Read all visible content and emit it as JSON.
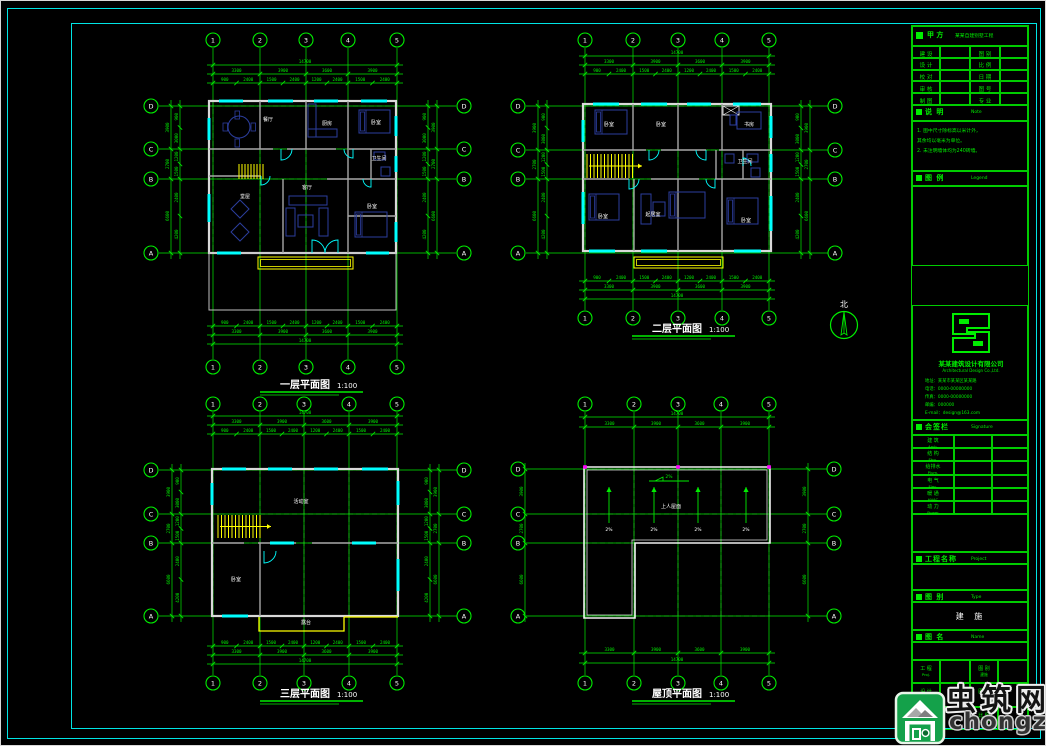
{
  "sheet": {
    "bg": "#000000",
    "frame_color": "#00e5e5",
    "grid_color": "#00ee00",
    "wall_color": "#d9d9d9",
    "inner_wall_color": "#a8a8a8",
    "furniture_color": "#2c3e9e",
    "highlight_color": "#ffff00",
    "window_color": "#00ffff",
    "axis_dot_color": "#ff00ff",
    "label_color": "#ffffff"
  },
  "north_arrow": {
    "label": "北"
  },
  "watermark": {
    "name": "虫筑网",
    "url": "chongzhu.cn"
  },
  "plans": [
    {
      "title": "一层平面图",
      "scale": "1:100",
      "cols": [
        "1",
        "2",
        "3",
        "4",
        "5"
      ],
      "rows": [
        "D",
        "C",
        "B",
        "A"
      ],
      "dims_x": [
        "3300",
        "3900",
        "3600",
        "3900"
      ],
      "total_x": "14700",
      "dims_x_fine": [
        "900",
        "2400",
        "1500",
        "2400",
        "1200",
        "2400",
        "1500",
        "2400"
      ],
      "dims_y": [
        "3900",
        "2700",
        "6600"
      ],
      "total_y": "13200",
      "dims_y_fine": [
        "900",
        "3000",
        "1200",
        "1500",
        "2400",
        "4200"
      ],
      "room_labels": [
        "餐厅",
        "厨房",
        "卧室",
        "客厅",
        "卫生间",
        "卧室",
        "堂屋"
      ]
    },
    {
      "title": "二层平面图",
      "scale": "1:100",
      "cols": [
        "1",
        "2",
        "3",
        "4",
        "5"
      ],
      "rows": [
        "D",
        "C",
        "B",
        "A"
      ],
      "dims_x": [
        "3300",
        "3900",
        "3600",
        "3900"
      ],
      "total_x": "14700",
      "dims_x_fine": [
        "900",
        "2400",
        "1500",
        "2400",
        "1200",
        "2400",
        "1500",
        "2400"
      ],
      "dims_y": [
        "3900",
        "2700",
        "6600"
      ],
      "total_y": "13200",
      "dims_y_fine": [
        "900",
        "3000",
        "1200",
        "1500",
        "2400",
        "4200"
      ],
      "room_labels": [
        "卧室",
        "卧室",
        "书房",
        "起居室",
        "卧室",
        "卧室",
        "卫生间"
      ]
    },
    {
      "title": "三层平面图",
      "scale": "1:100",
      "cols": [
        "1",
        "2",
        "3",
        "4",
        "5"
      ],
      "rows": [
        "D",
        "C",
        "B",
        "A"
      ],
      "dims_x": [
        "3300",
        "3900",
        "3600",
        "3900"
      ],
      "total_x": "14700",
      "dims_x_fine": [
        "900",
        "2400",
        "1500",
        "2400",
        "1200",
        "2400",
        "1500",
        "2400"
      ],
      "dims_y": [
        "3900",
        "2700",
        "6600"
      ],
      "total_y": "13200",
      "dims_y_fine": [
        "900",
        "3000",
        "1200",
        "1500",
        "2400",
        "4200"
      ],
      "room_labels": [
        "活动室",
        "卧室",
        "露台"
      ]
    },
    {
      "title": "屋顶平面图",
      "scale": "1:100",
      "cols": [
        "1",
        "2",
        "3",
        "4",
        "5"
      ],
      "rows": [
        "D",
        "C",
        "B",
        "A"
      ],
      "dims_x": [
        "3300",
        "3900",
        "3600",
        "3900"
      ],
      "total_x": "14700",
      "dims_y": [
        "3900",
        "2700",
        "6600"
      ],
      "total_y": "13200",
      "room_labels": [
        "上人屋面"
      ],
      "slope_labels": [
        "2%",
        "2%",
        "2%",
        "2%"
      ],
      "slope_note": "2%"
    }
  ],
  "title_block": {
    "owner": {
      "label": "甲 方",
      "value": "某某自建别墅工程"
    },
    "info_rows": [
      {
        "l": "建 设",
        "r": "图 别"
      },
      {
        "l": "设 计",
        "r": "比 例"
      },
      {
        "l": "校 对",
        "r": "日 期"
      },
      {
        "l": "审 核",
        "r": "图 号"
      },
      {
        "l": "制 图",
        "r": "专 业"
      }
    ],
    "notes": {
      "label": "说 明",
      "sub": "Note",
      "lines": [
        "1. 图中尺寸除标高以米计外，",
        "   其余均以毫米为单位。",
        "2. 未注明墙体均为240砖墙。"
      ]
    },
    "legend": {
      "label": "图 例",
      "sub": "Legend"
    },
    "company": {
      "name": "某某建筑设计有限公司",
      "en": "Architectural Design Co.,Ltd.",
      "contacts": [
        "地址：某某市某某区某某路",
        "电话：0000-00000000",
        "传真：0000-00000000",
        "邮编：000000",
        "E-mail：design@163.com"
      ]
    },
    "sign": {
      "label": "会签栏",
      "sub": "Signature",
      "rows": [
        {
          "c": "建 筑",
          "e": "Arch."
        },
        {
          "c": "结 构",
          "e": "Stru."
        },
        {
          "c": "给排水",
          "e": "Plum."
        },
        {
          "c": "电 气",
          "e": "Elec."
        },
        {
          "c": "暖 通",
          "e": "HVAC"
        },
        {
          "c": "动 力",
          "e": "Power"
        }
      ]
    },
    "project": {
      "label": "工程名称",
      "sub": "Project"
    },
    "type": {
      "label": "图 别",
      "sub": "Type",
      "value": "建 施"
    },
    "name_sec": {
      "label": "图 名",
      "sub": "Name"
    },
    "bottom_rows": [
      {
        "l1": "工 程",
        "s1": "Proj.",
        "l2": "图 别",
        "s2": "建施"
      },
      {
        "l1": "设 计",
        "s1": "Des.",
        "l2": "图 号",
        "s2": "01"
      },
      {
        "l1": "日 期",
        "s1": "Date",
        "l2": "比 例",
        "s2": "1:100"
      }
    ]
  }
}
